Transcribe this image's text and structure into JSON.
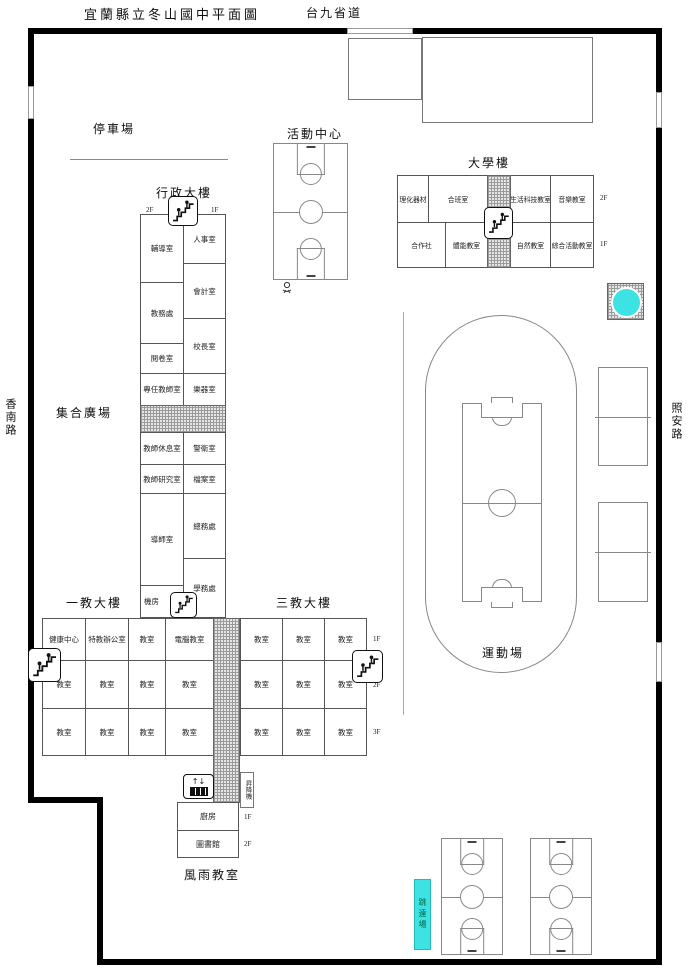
{
  "page": {
    "title": "宜蘭縣立冬山國中平面圖"
  },
  "roads": {
    "top": "台九省道",
    "left": "香南路",
    "right": "照安路"
  },
  "labels": {
    "parking": "停車場",
    "activity_center": "活動中心",
    "assembly_plaza": "集合廣場",
    "sports_field": "運動場",
    "rain_classroom": "風雨教室",
    "long_jump": "跳遠場"
  },
  "admin_building": {
    "name": "行政大樓",
    "left_floor": "2F",
    "right_floor": "1F",
    "left_rooms": [
      "輔導室",
      "教務處",
      "閱卷室",
      "專任教師室",
      "教師休息室",
      "教師研究室",
      "導師室",
      "機房"
    ],
    "right_rooms": [
      "人事室",
      "會計室",
      "校長室",
      "樂器室",
      "警衛室",
      "檔案室",
      "總務處",
      "學務處"
    ]
  },
  "daxue_building": {
    "name": "大學樓",
    "f2_label": "2F",
    "f1_label": "1F",
    "f2_rooms": [
      "理化器材",
      "合班室",
      "生活科技教室",
      "音樂教室"
    ],
    "f1_rooms": [
      "合作社",
      "體能教室",
      "自然教室",
      "綜合活動教室"
    ]
  },
  "building_one": {
    "name": "一教大樓",
    "row1": [
      "健康中心",
      "特教辦公室",
      "教室",
      "電腦教室"
    ],
    "row2": [
      "教室",
      "教室",
      "教室",
      "教室"
    ],
    "row3": [
      "教室",
      "教室",
      "教室",
      "教室"
    ]
  },
  "building_three": {
    "name": "三教大樓",
    "floors": [
      "1F",
      "2F",
      "3F"
    ],
    "row1": [
      "教室",
      "教室",
      "教室"
    ],
    "row2": [
      "教室",
      "教室",
      "教室"
    ],
    "row3": [
      "教室",
      "教室",
      "教室"
    ]
  },
  "south_block": {
    "elevator": "昇降機",
    "elevator_arrows": "↑↓",
    "kitchen": "廚房",
    "kitchen_floor": "1F",
    "library": "圖書館",
    "library_floor": "2F"
  },
  "icons": {
    "stairs": "stairs-people",
    "elevator": "elevator-updown",
    "pool": "water-feature",
    "figure": "small-figure"
  },
  "colors": {
    "cyan": "#3DE3E3",
    "wall": "#000000",
    "line": "#888888"
  }
}
